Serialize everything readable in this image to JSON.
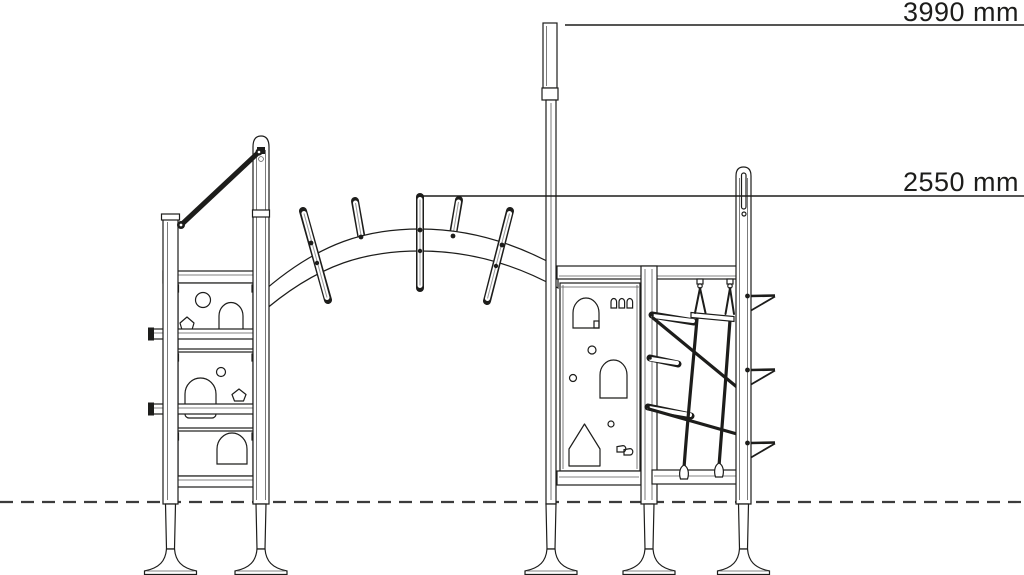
{
  "drawing": {
    "view": "side elevation",
    "background_color": "#ffffff",
    "line_color": "#1d1d1b",
    "ground_line_style": "dashed"
  },
  "annotations": {
    "dim_total_height": "3990 mm",
    "dim_upper_height": "2550 mm"
  }
}
